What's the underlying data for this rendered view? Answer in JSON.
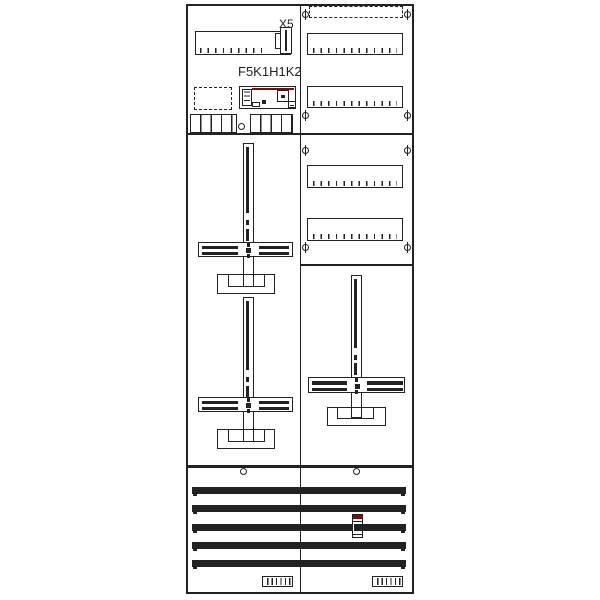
{
  "diagram": {
    "type": "electrical-distribution-board-layout",
    "labels": {
      "terminal_connector": "X5",
      "device_group": "F5K1H1K2"
    },
    "colors": {
      "line": "#222222",
      "accent_red": "#7b0d0d",
      "background": "#ffffff"
    },
    "busbars": {
      "count": 5
    }
  }
}
